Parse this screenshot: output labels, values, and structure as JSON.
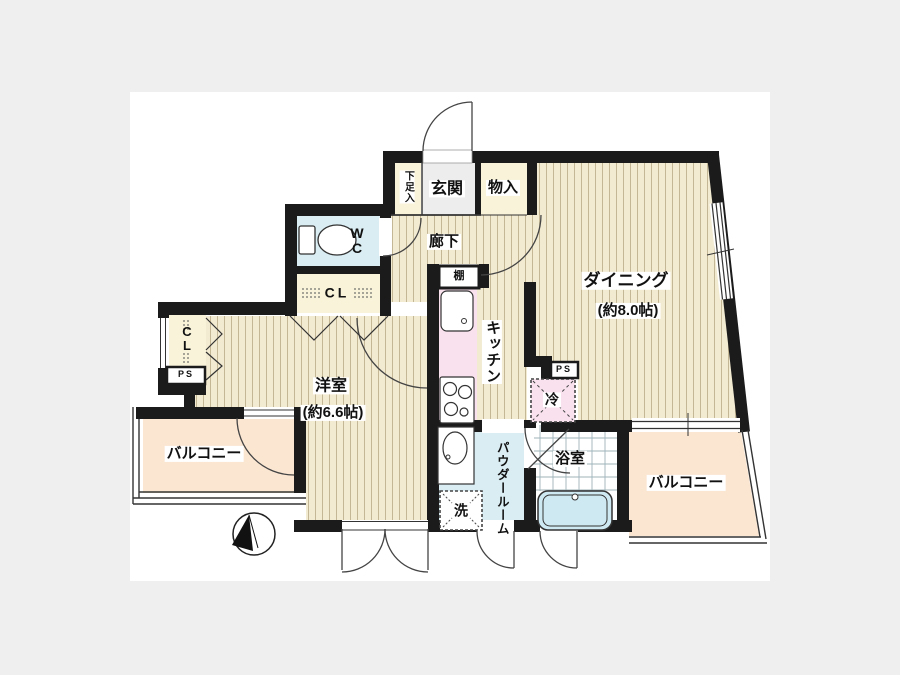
{
  "document": {
    "type": "apartment-floor-plan"
  },
  "palette": {
    "page_background": "#efeff0",
    "plan_background": "#ffffff",
    "wall": "#1b1b1b",
    "wood_floor": "#f2ead1",
    "wood_stripe": "#94805четыре",
    "closet_cream": "#f8f3d9",
    "wet_area_blue": "#d9edf3",
    "kitchen_pink": "#f9e2ee",
    "balcony_peach": "#fbe6d2",
    "entrance_gray": "#ededed",
    "bathtub_blue": "#cfe9f2"
  },
  "rooms": {
    "entrance": {
      "label": "玄関"
    },
    "shoe_cabinet": {
      "label": "下足入"
    },
    "storage": {
      "label": "物入"
    },
    "hallway": {
      "label": "廊下"
    },
    "shelf": {
      "label": "棚"
    },
    "toilet": {
      "label": "W\nC"
    },
    "closet_hall": {
      "label": "CL"
    },
    "closet_bedroom": {
      "label": "C\nL"
    },
    "pipe_space_left": {
      "label": "PS"
    },
    "pipe_space_right": {
      "label": "PS"
    },
    "kitchen": {
      "label": "キッチン"
    },
    "refrigerator": {
      "label": "冷"
    },
    "dining": {
      "label": "ダイニング",
      "size": "(約8.0帖)"
    },
    "bedroom": {
      "label": "洋室",
      "size": "(約6.6帖)"
    },
    "balcony_left": {
      "label": "バルコニー"
    },
    "balcony_right": {
      "label": "バルコニー"
    },
    "powder_room": {
      "label": "パウダールーム"
    },
    "washer": {
      "label": "洗"
    },
    "bathroom": {
      "label": "浴室"
    }
  }
}
